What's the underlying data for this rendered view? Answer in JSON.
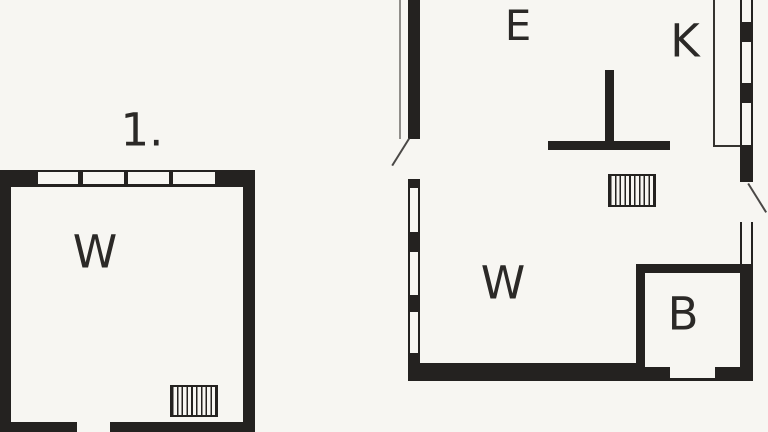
{
  "canvas": {
    "background_color": "#f7f6f2",
    "wall_color": "#242220",
    "thin_line_color": "#35332f",
    "door_swing_color": "#4a4846",
    "text_color": "#2b2927"
  },
  "building_1": {
    "number_label": "1.",
    "rooms": [
      {
        "label": "W"
      }
    ],
    "features": [
      "four-window-top-wall",
      "door-opening-bottom-wall",
      "stairs-hatch-symbol"
    ]
  },
  "building_2": {
    "rooms": [
      {
        "label": "E"
      },
      {
        "label": "K"
      },
      {
        "label": "W"
      },
      {
        "label": "B"
      }
    ],
    "features": [
      "windows-left-wall",
      "windows-right-wall",
      "door-left-wall",
      "door-right-wall",
      "interior-t-wall",
      "stairs-hatch-symbol",
      "door-opening-bottom-wall"
    ]
  }
}
